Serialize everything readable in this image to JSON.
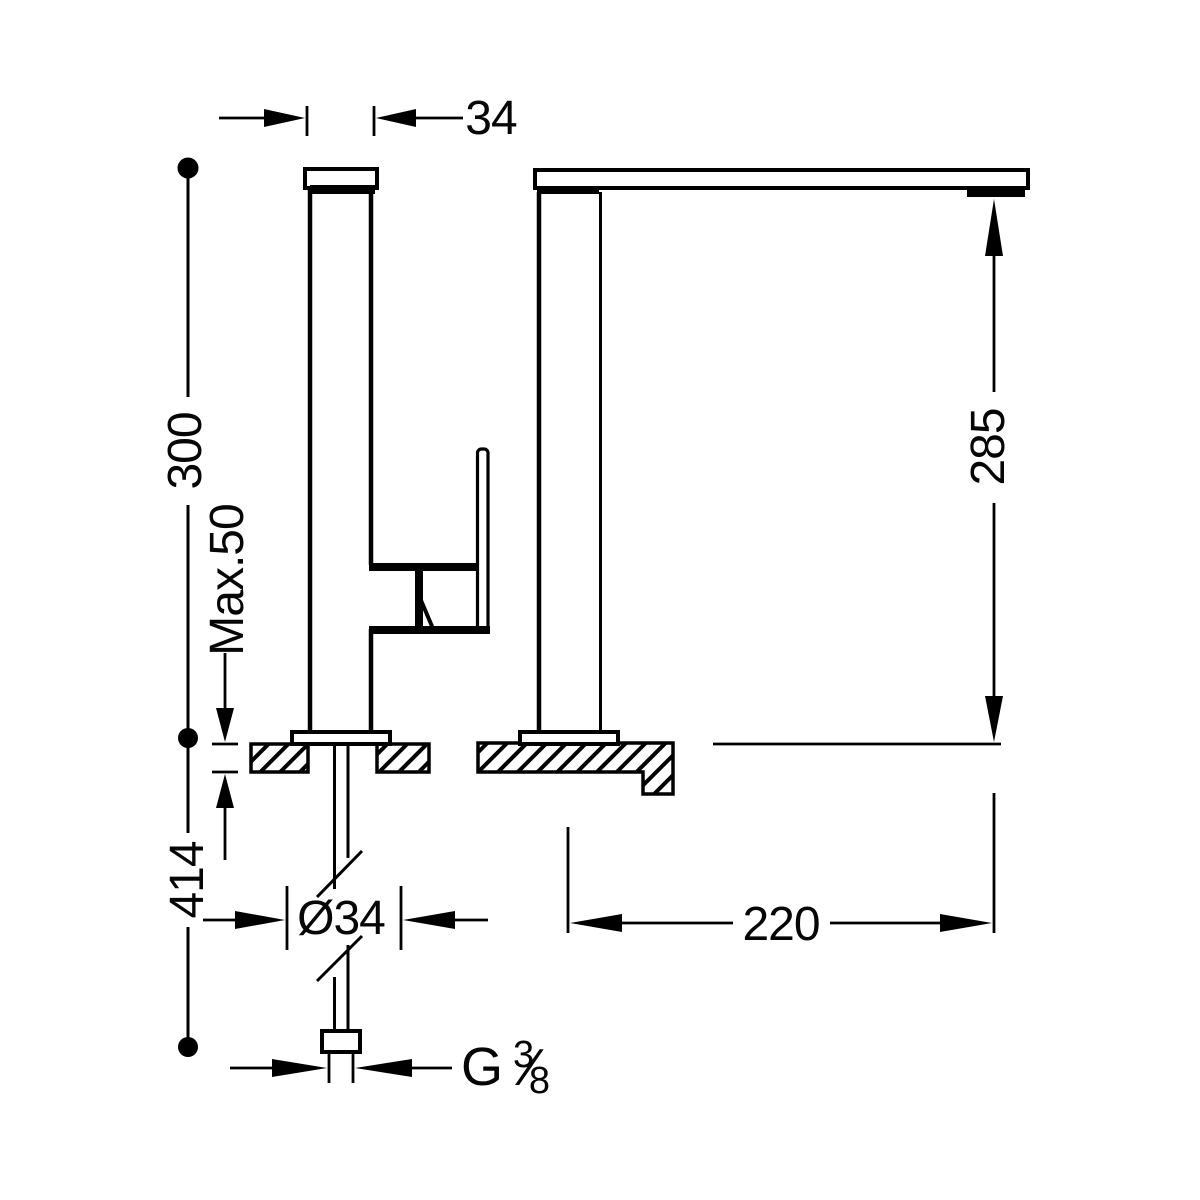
{
  "drawing": {
    "colors": {
      "line": "#000000",
      "background": "#ffffff"
    },
    "dims": {
      "spout_body_width": "34",
      "height_to_counter": "300",
      "max_mounting_thickness": "Max.50",
      "under_counter_length": "414",
      "outlet_height": "285",
      "spout_reach": "220",
      "shank_diameter": "Ø34",
      "thread": {
        "prefix": "G",
        "numerator": "3",
        "denominator": "8",
        "slash": "⁄"
      }
    }
  }
}
